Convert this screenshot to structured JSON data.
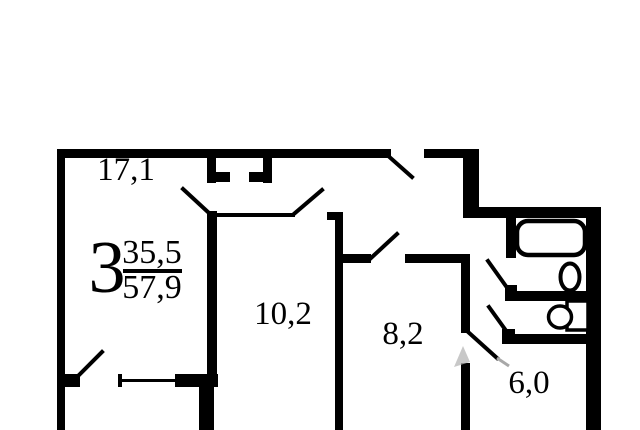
{
  "plan": {
    "apartment": {
      "rooms_count": "3",
      "living_area": "35,5",
      "total_area": "57,9"
    },
    "rooms": [
      {
        "id": "room-17-1",
        "area": "17,1"
      },
      {
        "id": "room-10-2",
        "area": "10,2"
      },
      {
        "id": "room-8-2",
        "area": "8,2"
      },
      {
        "id": "kitchen-6-0",
        "area": "6,0"
      }
    ],
    "fixtures": [
      "bathtub",
      "sink",
      "toilet"
    ],
    "colors": {
      "walls": "#000000",
      "background": "#ffffff",
      "watermark": "#b0b0b0"
    }
  }
}
